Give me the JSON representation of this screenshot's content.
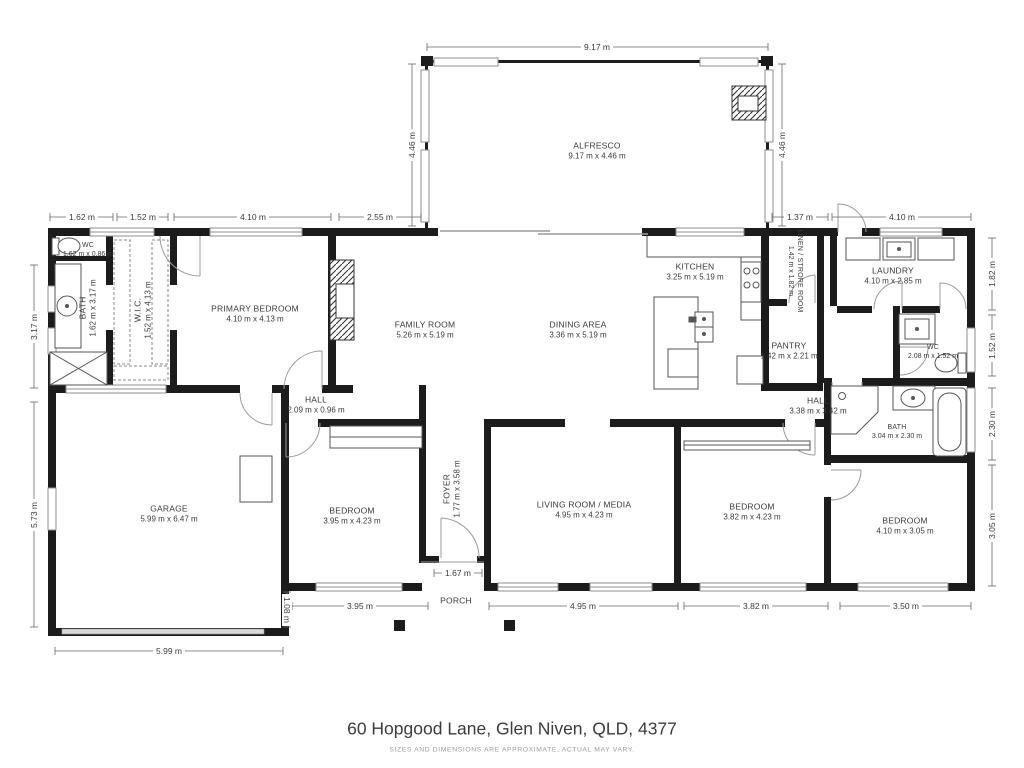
{
  "title": "60 Hopgood Lane, Glen Niven, QLD, 4377",
  "disclaimer": "SIZES AND DIMENSIONS ARE APPROXIMATE, ACTUAL MAY VARY.",
  "colors": {
    "wall": "#1c1c1c",
    "text": "#3b3b3b"
  },
  "rooms": {
    "alfresco": {
      "name": "ALFRESCO",
      "dims": "9.17 m x 4.46 m"
    },
    "wc_front": {
      "name": "WC",
      "dims": "1.62 m x 0.86 m"
    },
    "bath_front": {
      "name": "BATH",
      "dims": "1.62 m x 3.17 m"
    },
    "wic": {
      "name": "W.I.C.",
      "dims": "1.52 m x 4.13 m"
    },
    "primary_bedroom": {
      "name": "PRIMARY BEDROOM",
      "dims": "4.10 m x 4.13 m"
    },
    "family_room": {
      "name": "FAMILY ROOM",
      "dims": "5.26 m x 5.19 m"
    },
    "dining_area": {
      "name": "DINING AREA",
      "dims": "3.36 m x 5.19 m"
    },
    "kitchen": {
      "name": "KITCHEN",
      "dims": "3.25 m x 5.19 m"
    },
    "linen_store": {
      "name": "LINEN / STRORE ROOM",
      "dims": "1.42 m x 1.82 m"
    },
    "pantry": {
      "name": "PANTRY",
      "dims": "1.42 m x 2.21 m"
    },
    "laundry": {
      "name": "LAUNDRY",
      "dims": "4.10 m x 2.85 m"
    },
    "wc_rear": {
      "name": "WC",
      "dims": "2.08 m x 1.52 m"
    },
    "hall_rear": {
      "name": "HALL",
      "dims": "3.38 m x 3.42 m"
    },
    "bath_rear": {
      "name": "BATH",
      "dims": "3.04 m x 2.30 m"
    },
    "bedroom_rear": {
      "name": "BEDROOM",
      "dims": "4.10 m x 3.05 m"
    },
    "bedroom_mid": {
      "name": "BEDROOM",
      "dims": "3.82 m x 4.23 m"
    },
    "living_media": {
      "name": "LIVING ROOM / MEDIA",
      "dims": "4.95 m x 4.23 m"
    },
    "foyer": {
      "name": "FOYER",
      "dims": "1.77 m x 3.58 m"
    },
    "hall_front": {
      "name": "HALL",
      "dims": "2.09 m x 0.96 m"
    },
    "bedroom_front": {
      "name": "BEDROOM",
      "dims": "3.95 m x 4.23 m"
    },
    "garage": {
      "name": "GARAGE",
      "dims": "5.99 m x 6.47 m"
    },
    "porch": {
      "name": "PORCH",
      "dims": ""
    }
  },
  "dims": {
    "t1": "1.62 m",
    "t2": "1.52 m",
    "t3": "4.10 m",
    "t4": "2.55 m",
    "t5": "1.37 m",
    "t6": "4.10 m",
    "alfresco_w": "9.17 m",
    "alfresco_dl": "4.46 m",
    "alfresco_dr": "4.46 m",
    "l1": "3.17 m",
    "l2": "5.73 m",
    "r1": "1.82 m",
    "r2": "1.52 m",
    "r3": "2.30 m",
    "r4": "3.05 m",
    "b1": "5.99 m",
    "b2": "3.95 m",
    "b3": "1.67 m",
    "b4": "4.95 m",
    "b5": "3.82 m",
    "b6": "3.50 m",
    "porch_depth": "1.08 m"
  }
}
